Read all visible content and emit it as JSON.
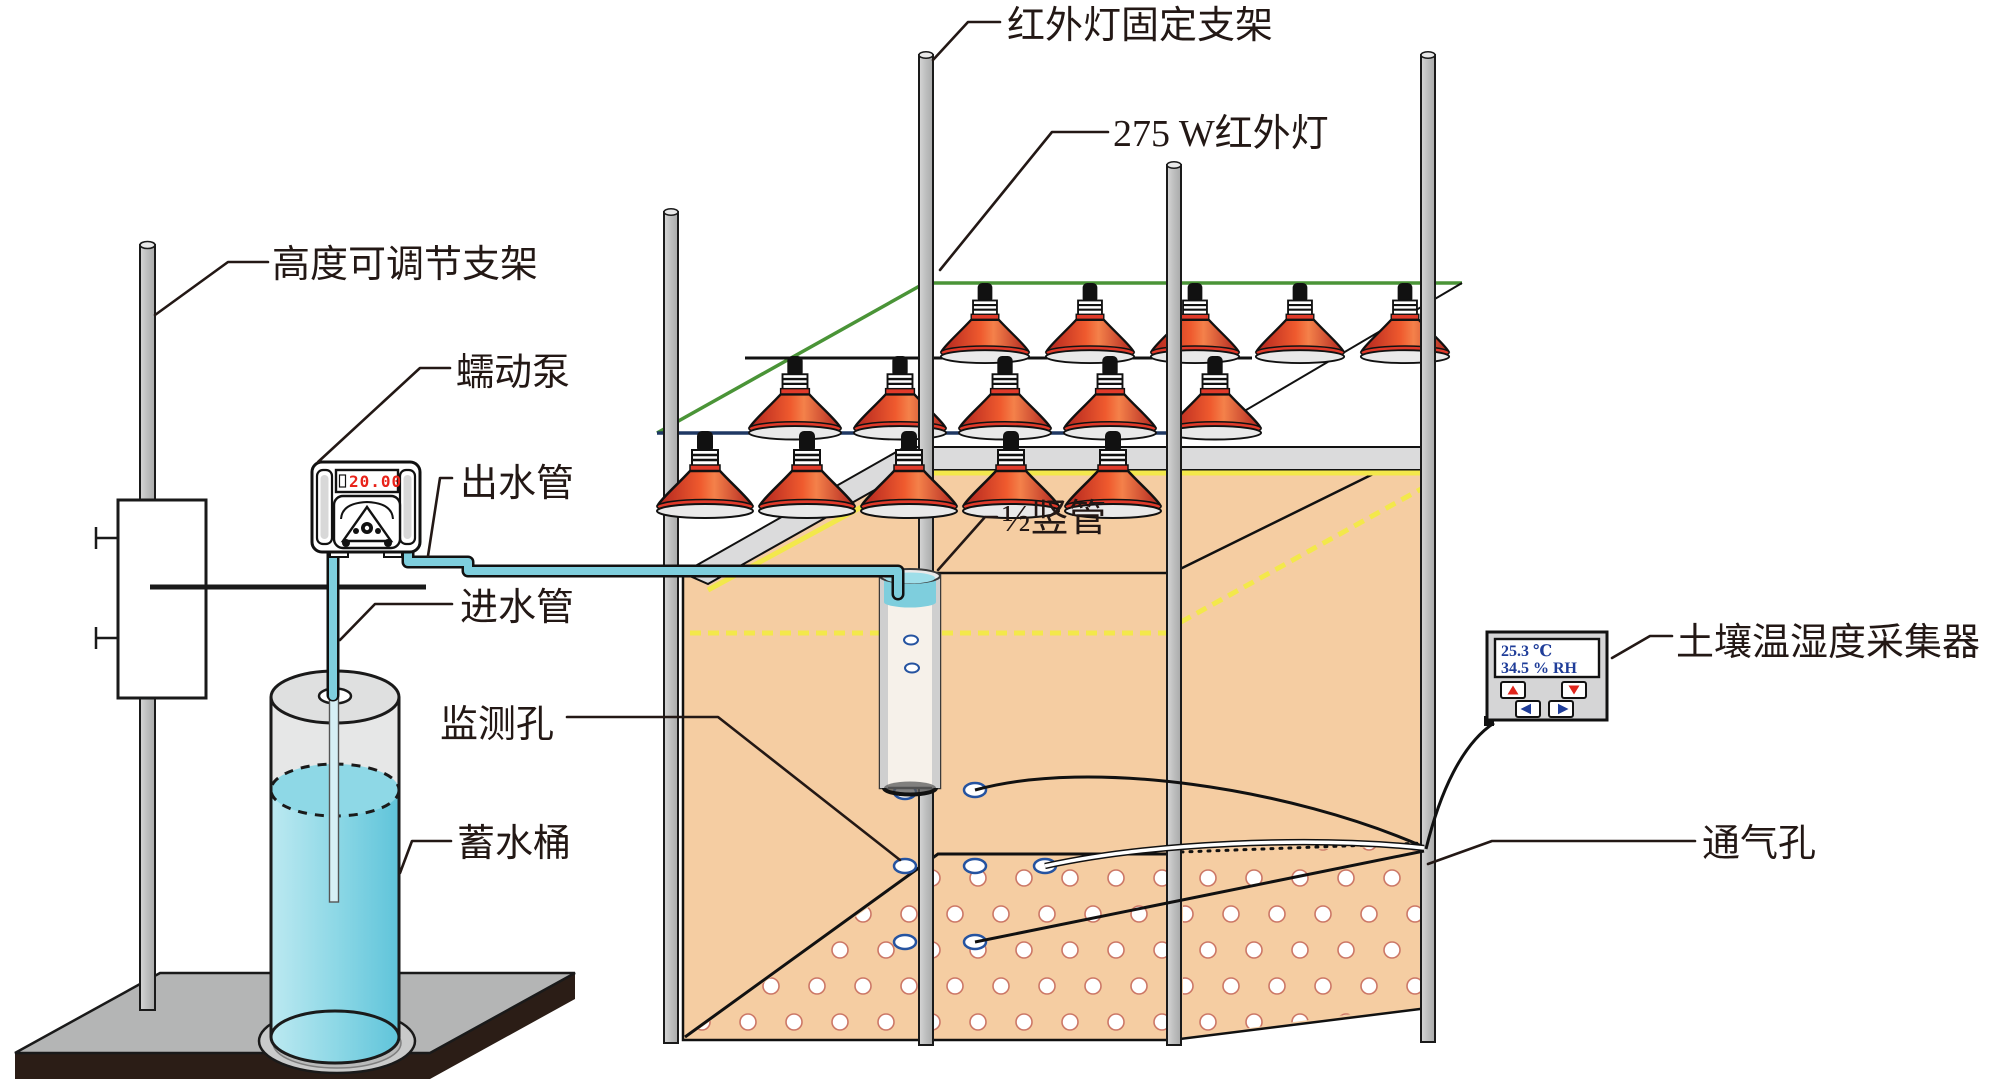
{
  "labels": {
    "fixing_bracket": "红外灯固定支架",
    "infrared_lamp": "275 W红外灯",
    "adjustable_stand": "高度可调节支架",
    "peristaltic_pump": "蠕动泵",
    "outlet_pipe": "出水管",
    "inlet_pipe": "进水管",
    "monitoring_holes": "监测孔",
    "water_bucket": "蓄水桶",
    "riser_pipe": "½竖管",
    "soil_sensor": "土壤温湿度采集器",
    "vent_holes": "通气孔"
  },
  "pump": {
    "display_value": "20.00"
  },
  "sensor": {
    "temperature": "25.3 ℃",
    "humidity": "34.5 % RH"
  },
  "colors": {
    "soil_tan": "#f5cda2",
    "water_teal": "#7ecedd",
    "lamp_red": "#d9341f",
    "frame_green": "#4a9437",
    "bar_navy": "#1f3864",
    "display_blue": "#1f3d99",
    "led_red": "#e8231a",
    "soil_line_yellow": "#f3e84b"
  }
}
